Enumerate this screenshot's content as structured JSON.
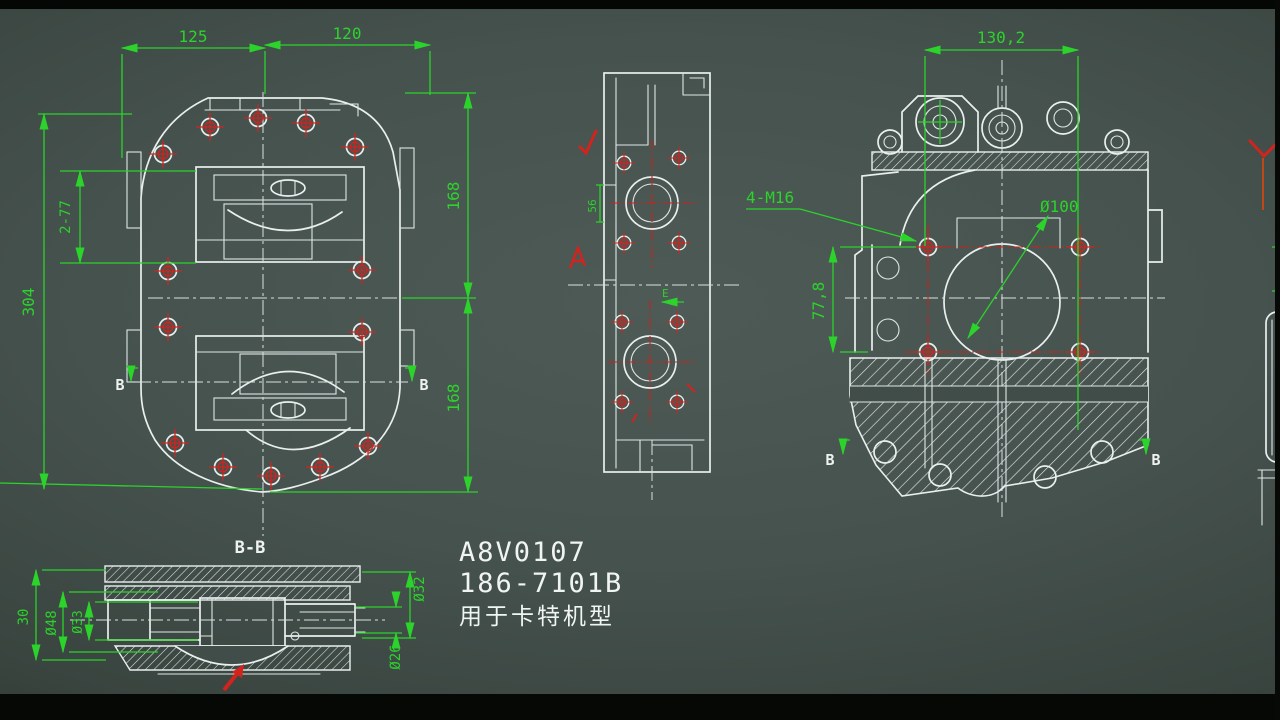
{
  "colors": {
    "background": "#414d49",
    "line_white": "#e9efee",
    "dim_green": "#2bd32b",
    "mark_red": "#d2231d"
  },
  "part_label": {
    "line1": "A8V0107",
    "line2": "186-7101B",
    "line3": "用于卡特机型"
  },
  "front_view": {
    "dim_top_left": "125",
    "dim_top_right": "120",
    "dim_left_overall": "304",
    "dim_left_inner": "2-77",
    "dim_right_upper": "168",
    "dim_right_lower": "168",
    "section_label_left": "B",
    "section_label_right": "B"
  },
  "side_view": {
    "dim_small": "56",
    "datum_label": "E"
  },
  "rear_view": {
    "dim_width": "130,2",
    "thread_callout": "4-M16",
    "bore_callout": "Ø100",
    "dim_height": "77,8",
    "section_label_left": "B",
    "section_label_right": "B"
  },
  "section_bb": {
    "title": "B-B",
    "dim_depth": "30",
    "dim_d48": "Ø48",
    "dim_d33": "Ø33",
    "dim_d32": "Ø32",
    "dim_d26": "Ø26"
  }
}
